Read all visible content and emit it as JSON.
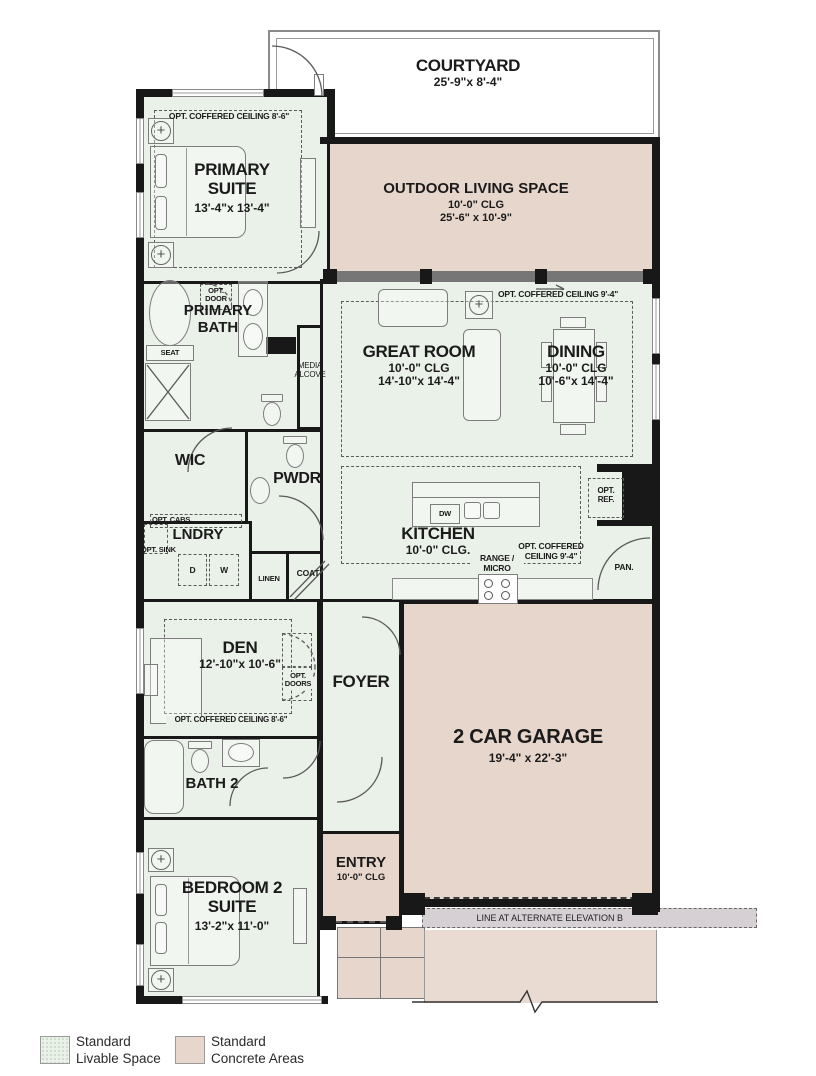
{
  "rooms": {
    "courtyard": {
      "name": "COURTYARD",
      "dims": "25'-9\"x 8'-4\""
    },
    "outdoor_living": {
      "name": "OUTDOOR LIVING SPACE",
      "clg": "10'-0\" CLG",
      "dims": "25'-6\" x 10'-9\""
    },
    "primary_suite": {
      "name": "PRIMARY SUITE",
      "dims": "13'-4\"x 13'-4\"",
      "ceiling_note": "OPT. COFFERED CEILING 8'-6\""
    },
    "primary_bath": {
      "name": "PRIMARY BATH",
      "opt_door": "OPT. DOOR",
      "seat": "SEAT"
    },
    "wic": {
      "name": "WIC"
    },
    "pwdr": {
      "name": "PWDR"
    },
    "lndry": {
      "name": "LNDRY",
      "opt_cabs": "OPT. CABS.",
      "opt_sink": "OPT. SINK",
      "dryer": "D",
      "washer": "W"
    },
    "linen": {
      "name": "LINEN"
    },
    "coat": {
      "name": "COAT"
    },
    "great_room": {
      "name": "GREAT ROOM",
      "clg": "10'-0\" CLG",
      "dims": "14'-10\"x 14'-4\"",
      "ceiling_note": "OPT. COFFERED CEILING 9'-4\""
    },
    "dining": {
      "name": "DINING",
      "clg": "10'-0\" CLG",
      "dims": "10'-6\"x 14'-4\""
    },
    "media_alcove": {
      "name": "MEDIA ALCOVE"
    },
    "kitchen": {
      "name": "KITCHEN",
      "clg": "10'-0\" CLG.",
      "ceiling_note": "OPT. COFFERED CEILING 9'-4\"",
      "dw": "DW",
      "range": "RANGE / MICRO",
      "opt_ref": "OPT. REF.",
      "pantry": "PAN."
    },
    "den": {
      "name": "DEN",
      "dims": "12'-10\"x 10'-6\"",
      "opt_doors": "OPT. DOORS",
      "ceiling_note": "OPT. COFFERED CEILING 8'-6\""
    },
    "foyer": {
      "name": "FOYER"
    },
    "garage": {
      "name": "2 CAR GARAGE",
      "dims": "19'-4\" x 22'-3\"",
      "alt_elevation_note": "LINE AT ALTERNATE ELEVATION B"
    },
    "bath2": {
      "name": "BATH 2"
    },
    "bedroom2": {
      "name": "BEDROOM 2 SUITE",
      "dims": "13'-2\"x 11'-0\""
    },
    "entry": {
      "name": "ENTRY",
      "clg": "10'-0\" CLG"
    }
  },
  "legend": {
    "livable": "Standard Livable Space",
    "concrete": "Standard Concrete Areas",
    "livable_color": "#eaf1e8",
    "concrete_color": "#e7d6cb"
  }
}
